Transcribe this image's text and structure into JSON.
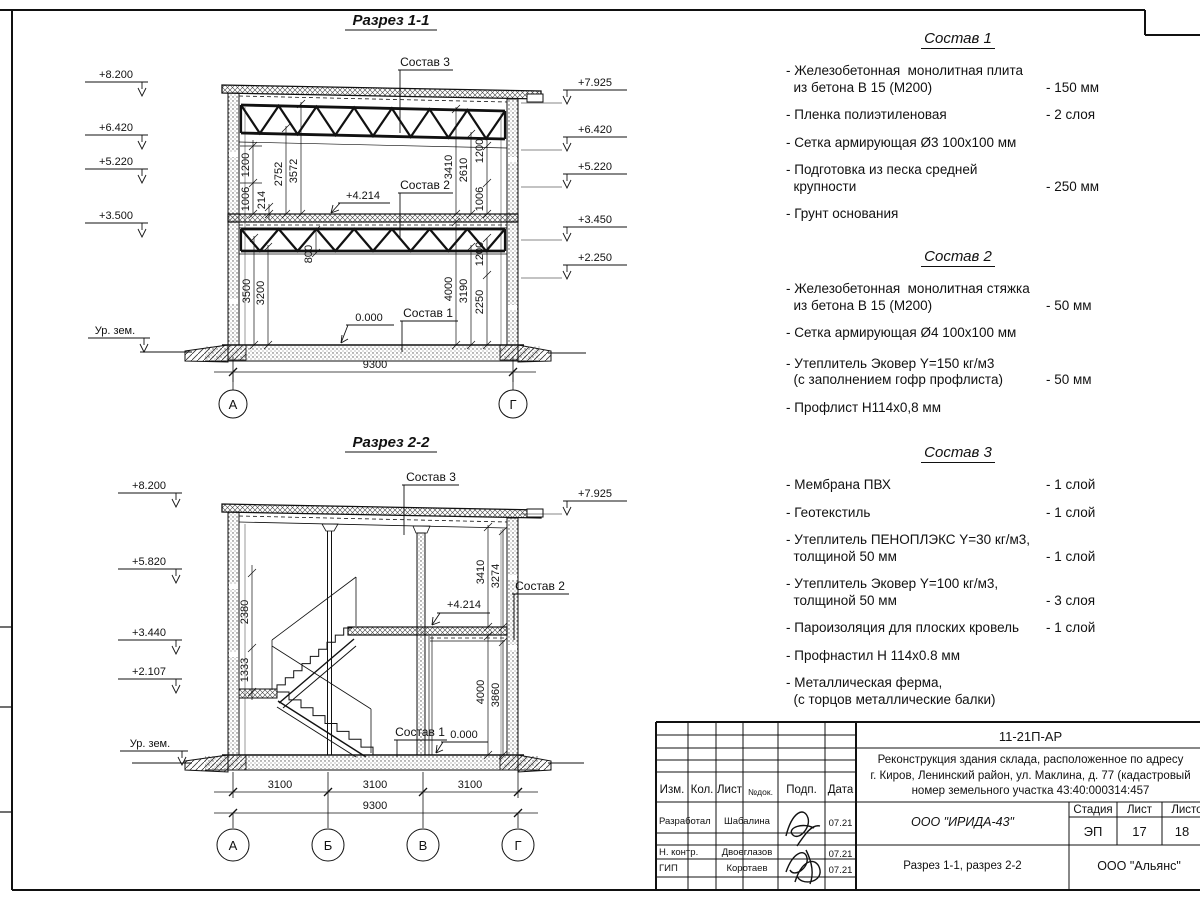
{
  "section1": {
    "title": "Разрез 1-1",
    "marks_left": [
      "+8.200",
      "+6.420",
      "+5.220",
      "+3.500"
    ],
    "marks_right": [
      "+7.925",
      "+6.420",
      "+5.220",
      "+3.450",
      "+2.250"
    ],
    "ground_label": "Ур. зем.",
    "labels": {
      "sostav1": "Состав 1",
      "sostav2": "Состав 2",
      "sostav3": "Состав 3",
      "level_mid": "+4.214",
      "level_zero": "0.000"
    },
    "dims": {
      "ul": [
        "1006",
        "1200",
        "214",
        "2752",
        "3572"
      ],
      "ur": [
        "3410",
        "2610",
        "1200",
        "1006"
      ],
      "ll": [
        "3500",
        "3200",
        "800"
      ],
      "lr": [
        "4000",
        "3190",
        "2250",
        "1200"
      ],
      "total": "9300"
    },
    "axes": [
      "А",
      "Г"
    ]
  },
  "section2": {
    "title": "Разрез 2-2",
    "marks_left": [
      "+8.200",
      "+5.820",
      "+3.440",
      "+2.107"
    ],
    "marks_right": [
      "+7.925"
    ],
    "ground_label": "Ур. зем.",
    "labels": {
      "sostav1": "Состав 1",
      "sostav2": "Состав 2",
      "sostav3": "Состав 3",
      "level_mid": "+4.214",
      "level_zero": "0.000"
    },
    "dims": {
      "left": [
        "2380",
        "1333"
      ],
      "ru": [
        "3410",
        "3274"
      ],
      "rl": [
        "4000",
        "3860"
      ],
      "bottom": [
        "3100",
        "3100",
        "3100"
      ],
      "total": "9300"
    },
    "axes": [
      "А",
      "Б",
      "В",
      "Г"
    ]
  },
  "lists": [
    {
      "title": "Состав 1",
      "items": [
        {
          "name": "- Железобетонная  монолитная плита\n  из бетона В 15 (М200)",
          "value": "- 150 мм"
        },
        {
          "name": "- Пленка полиэтиленовая",
          "value": "-  2 слоя"
        },
        {
          "name": "- Сетка армирующая Ø3 100х100 мм",
          "value": ""
        },
        {
          "name": "- Подготовка из песка средней\n  крупности",
          "value": "- 250 мм"
        },
        {
          "name": "- Грунт основания",
          "value": ""
        }
      ]
    },
    {
      "title": "Состав 2",
      "items": [
        {
          "name": "- Железобетонная  монолитная стяжка\n  из бетона В 15 (М200)",
          "value": "- 50 мм"
        },
        {
          "name": "- Сетка армирующая Ø4 100х100 мм",
          "value": ""
        },
        {
          "name": "- Утеплитель Эковер Y=150 кг/м3\n  (с заполнением гофр профлиста)",
          "value": "- 50 мм"
        },
        {
          "name": "- Профлист Н114х0,8 мм",
          "value": ""
        }
      ]
    },
    {
      "title": "Состав 3",
      "items": [
        {
          "name": "- Мембрана ПВХ",
          "value": "- 1 слой"
        },
        {
          "name": "- Геотекстиль",
          "value": "- 1 слой"
        },
        {
          "name": "- Утеплитель ПЕНОПЛЭКС Y=30 кг/м3,\n  толщиной 50 мм",
          "value": "- 1 слой"
        },
        {
          "name": "- Утеплитель Эковер Y=100 кг/м3,\n  толщиной 50 мм",
          "value": "- 3 слоя"
        },
        {
          "name": "- Пароизоляция для плоских кровель",
          "value": "- 1 слой"
        },
        {
          "name": "- Профнастил Н 114х0.8 мм",
          "value": ""
        },
        {
          "name": "- Металлическая ферма,\n  (с торцов металлические балки)",
          "value": ""
        }
      ]
    }
  ],
  "titleblock": {
    "doc_code": "11-21П-АР",
    "description": "Реконструкция здания склада, расположенное по адресу\nг. Киров, Ленинский район, ул. Маклина, д. 77 (кадастровый\nномер земельного участка 43:40:000314:457",
    "col_izm": "Изм.",
    "col_kol": "Кол.",
    "col_list": "Лист",
    "col_ndok": "№док.",
    "col_podp": "Подп.",
    "col_data": "Дата",
    "rows": [
      {
        "role": "Разработал",
        "name": "Шабалина",
        "date": "07.21"
      },
      {
        "role": "Н. контр.",
        "name": "Двоеглазов",
        "date": "07.21"
      },
      {
        "role": "ГИП",
        "name": "Коротаев",
        "date": "07.21"
      }
    ],
    "org": "ООО \"ИРИДА-43\"",
    "stage_label": "Стадия",
    "sheet_label": "Лист",
    "sheets_label": "Листов",
    "stage": "ЭП",
    "sheet": "17",
    "sheets": "18",
    "subtitle": "Разрез 1-1, разрез 2-2",
    "company": "ООО \"Альянс\""
  }
}
